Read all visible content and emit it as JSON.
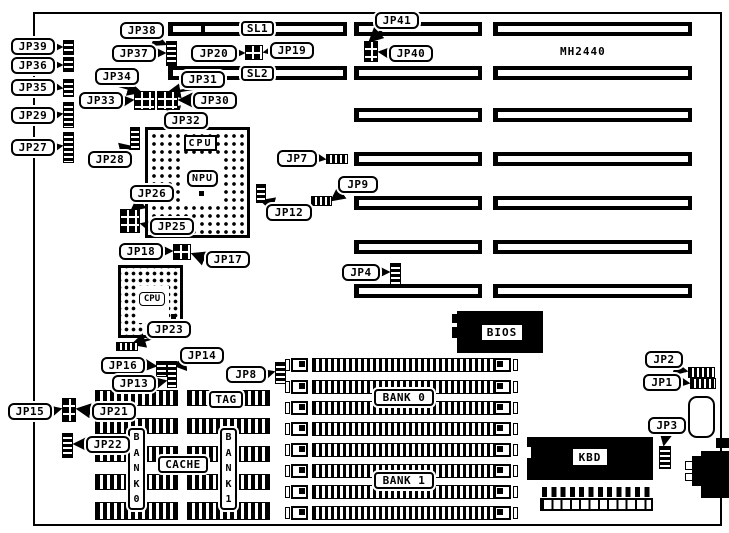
{
  "board": {
    "model": "MH2440"
  },
  "slots": {
    "sl1": "SL1",
    "sl2": "SL2"
  },
  "jumpers": {
    "jp1": "JP1",
    "jp2": "JP2",
    "jp3": "JP3",
    "jp4": "JP4",
    "jp7": "JP7",
    "jp8": "JP8",
    "jp9": "JP9",
    "jp12": "JP12",
    "jp13": "JP13",
    "jp14": "JP14",
    "jp15": "JP15",
    "jp16": "JP16",
    "jp17": "JP17",
    "jp18": "JP18",
    "jp19": "JP19",
    "jp20": "JP20",
    "jp21": "JP21",
    "jp22": "JP22",
    "jp23": "JP23",
    "jp25": "JP25",
    "jp26": "JP26",
    "jp27": "JP27",
    "jp28": "JP28",
    "jp29": "JP29",
    "jp30": "JP30",
    "jp31": "JP31",
    "jp32": "JP32",
    "jp33": "JP33",
    "jp34": "JP34",
    "jp35": "JP35",
    "jp36": "JP36",
    "jp37": "JP37",
    "jp38": "JP38",
    "jp39": "JP39",
    "jp40": "JP40",
    "jp41": "JP41"
  },
  "chips": {
    "cpu_socket": "CPU",
    "npu": "NPU",
    "cpu2": "CPU",
    "bios": "BIOS",
    "kbd": "KBD"
  },
  "cache": {
    "tag": "TAG",
    "label": "CACHE",
    "bank0_vertical": "B\nA\nN\nK\n0",
    "bank1_vertical": "B\nA\nN\nK\n1"
  },
  "memory": {
    "bank0": "BANK 0",
    "bank1": "BANK 1"
  },
  "colors": {
    "ink": "#000000",
    "paper": "#ffffff"
  }
}
